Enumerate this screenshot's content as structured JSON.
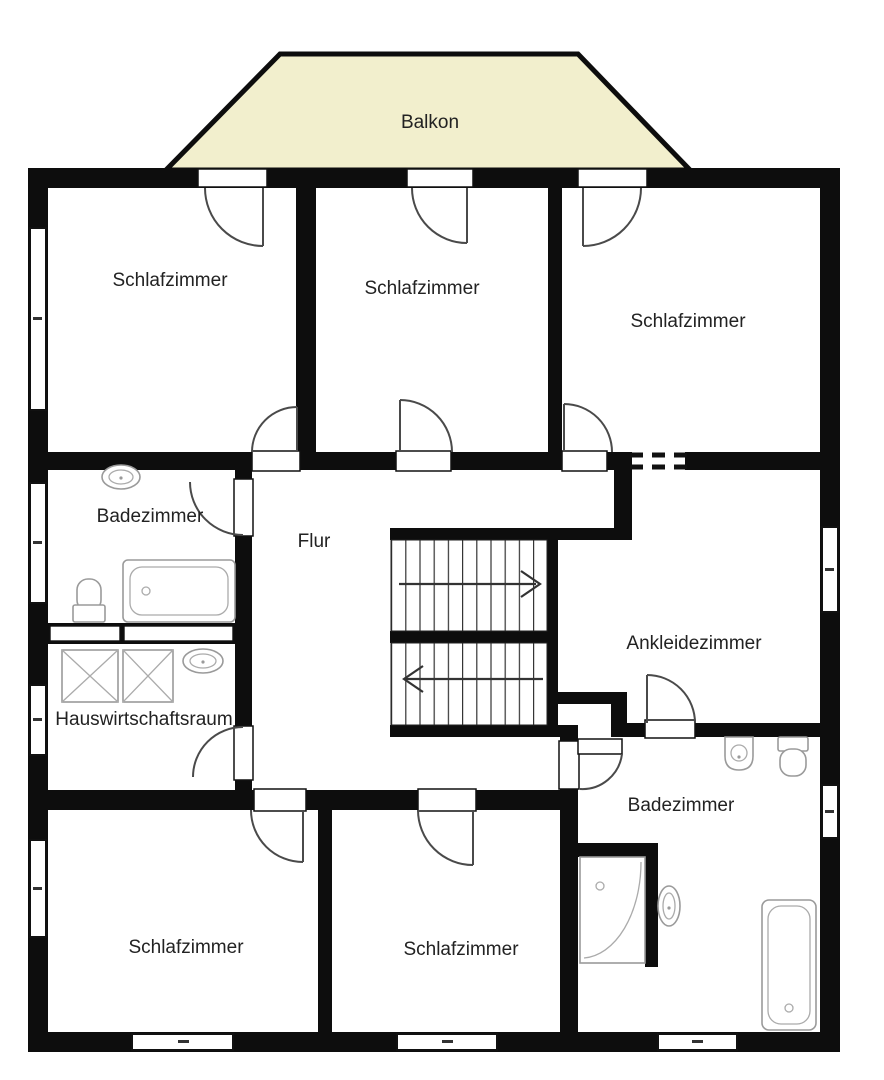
{
  "floorplan": {
    "balcony": {
      "label": "Balkon"
    },
    "rooms": [
      {
        "id": "schlafzimmer-top-left",
        "label": "Schlafzimmer"
      },
      {
        "id": "schlafzimmer-top-middle",
        "label": "Schlafzimmer"
      },
      {
        "id": "schlafzimmer-top-right",
        "label": "Schlafzimmer"
      },
      {
        "id": "badezimmer-upper",
        "label": "Badezimmer"
      },
      {
        "id": "flur",
        "label": "Flur"
      },
      {
        "id": "ankleidezimmer",
        "label": "Ankleidezimmer"
      },
      {
        "id": "hauswirtschaftsraum",
        "label": "Hauswirtschaftsraum"
      },
      {
        "id": "schlafzimmer-bottom-left",
        "label": "Schlafzimmer"
      },
      {
        "id": "schlafzimmer-bottom-middle",
        "label": "Schlafzimmer"
      },
      {
        "id": "badezimmer-lower",
        "label": "Badezimmer"
      }
    ],
    "stairs": {
      "upper_flight_arrow": "right",
      "lower_flight_arrow": "left"
    },
    "colors": {
      "balcony_fill": "#f2efcd",
      "wall": "#0d0d0d",
      "label_text": "#222222",
      "fixture_stroke": "#9a9a9a",
      "background": "#ffffff"
    },
    "fixtures": [
      "sink",
      "bathtub",
      "toilet",
      "washing-machine",
      "washing-machine",
      "sink",
      "sink",
      "toilet",
      "shower",
      "sink",
      "bathtub"
    ]
  }
}
